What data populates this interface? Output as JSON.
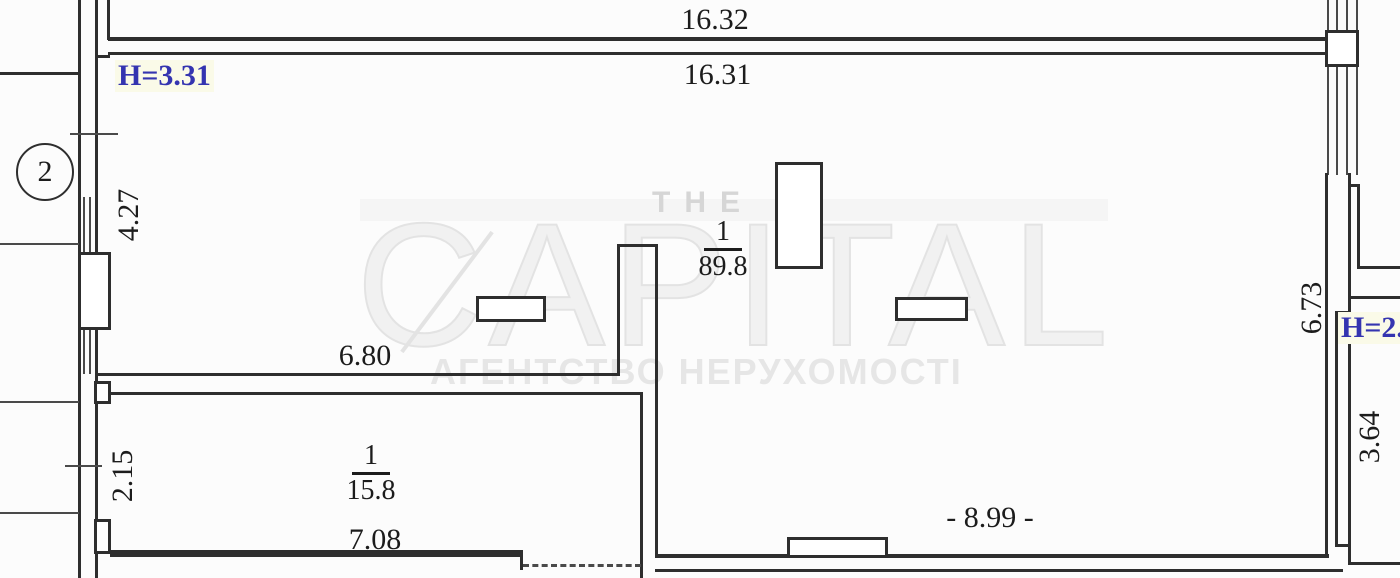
{
  "plan": {
    "axis_bubble": "2",
    "heights": {
      "left": "H=3.31",
      "right": "H=2.7"
    },
    "dimensions": {
      "top_outer": "16.32",
      "top_inner": "16.31",
      "left_upper": "4.27",
      "hall_width": "6.80",
      "left_lower": "2.15",
      "room2_width": "7.08",
      "bottom": "- 8.99 -",
      "right_upper": "6.73",
      "right_lower": "3.64"
    },
    "rooms": [
      {
        "number": "1",
        "area": "89.8"
      },
      {
        "number": "1",
        "area": "15.8"
      }
    ],
    "watermark": {
      "line1": "THE",
      "line2": "CAPITAL",
      "line3": "АГЕНТСТВО НЕРУХОМОСТІ"
    }
  },
  "colors": {
    "bg": "#fcfcfc",
    "line": "#2e2e2e",
    "line_soft": "#4a4a4a",
    "dim_text": "#1c1c1c",
    "height_text": "#3434b0",
    "height_bg": "#fafae8",
    "wm_band": "#f5f5f5",
    "wm_light": "#f1f1f1",
    "wm_stroke": "#e3e3e3",
    "wm_mid": "#d6d6d6",
    "wm_text": "#e6e6e6"
  }
}
